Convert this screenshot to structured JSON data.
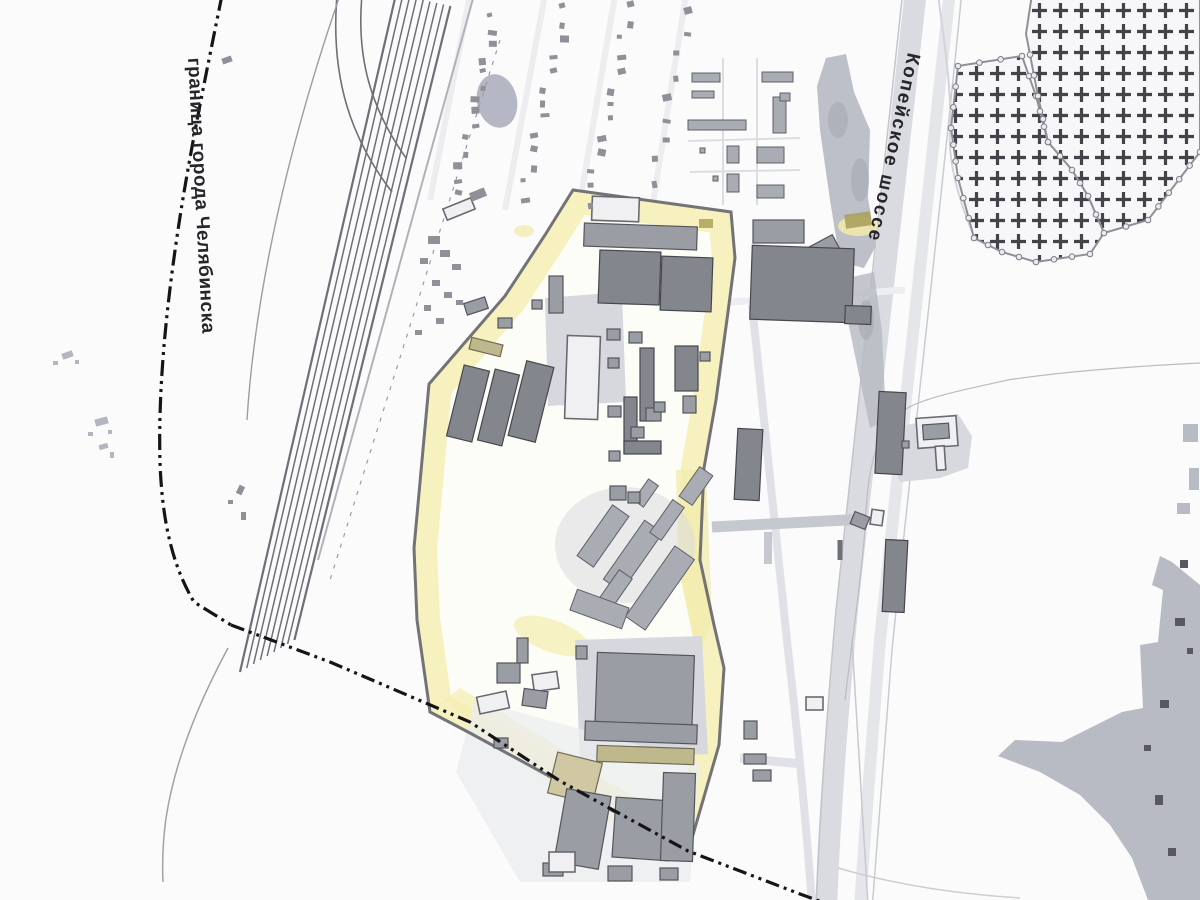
{
  "labels": {
    "city_boundary": "граница города Челябинска",
    "highway": "Копейское шоссе"
  },
  "palette": {
    "paper": "#fbfbfc",
    "boundary_line": "#151517",
    "site_outline": "#6b6c72",
    "site_fill": "#fdfdf8",
    "site_highlight": "#f5eeb4",
    "site_highlight_strong": "#efe490",
    "building_gray": "#9b9da5",
    "building_dark": "#84868e",
    "building_khaki": "#bfb88c",
    "building_khaki_light": "#cfc8a2",
    "building_outline_light": "#f0f0f3",
    "railway": "#6e7077",
    "road_light": "#dfe1e6",
    "road_medium": "#c5c8ce",
    "highway_fill": "#d9dbe0",
    "vegetation": "#b6b9c2",
    "gray_area": "#b8bbc3",
    "cemetery_cross": "#43444a",
    "cemetery_fence": "#8f9197",
    "pond": "#b5b7c4",
    "olive_patch": "#a89e58"
  },
  "features": [
    {
      "id": "city-boundary",
      "kind": "administrative-boundary",
      "style": "dash-dot-dot",
      "label": "граница города Челябинска"
    },
    {
      "id": "kopeyskoye-highway",
      "kind": "highway",
      "label": "Копейское шоссе"
    },
    {
      "id": "railway-corridor",
      "kind": "railway-tracks",
      "label": ""
    },
    {
      "id": "industrial-site",
      "kind": "surveyed-site-yellow-highlight",
      "label": ""
    },
    {
      "id": "cemetery",
      "kind": "cemetery-cross-hatched",
      "label": ""
    },
    {
      "id": "settlement",
      "kind": "small-buildings-cluster",
      "label": ""
    },
    {
      "id": "gray-area-southeast",
      "kind": "built-up-area",
      "label": ""
    }
  ]
}
